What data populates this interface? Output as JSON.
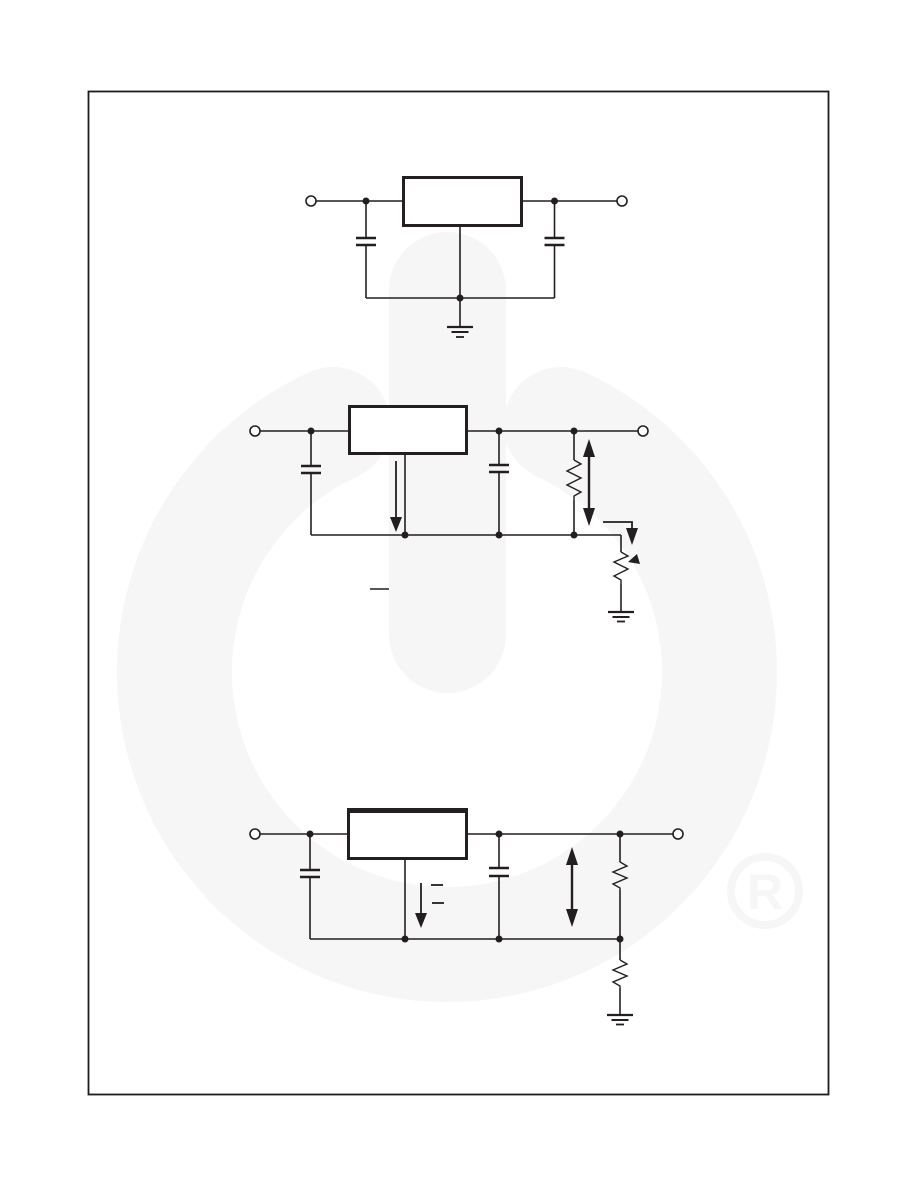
{
  "page": {
    "width": 918,
    "height": 1188,
    "background_color": "#ffffff",
    "frame_color": "#1c1c1c",
    "schematic_line_color": "#231f20",
    "watermark": {
      "name": "power-symbol-logo-watermark",
      "color": "#f6f6f7",
      "registered_mark": "R"
    }
  },
  "figures": [
    {
      "name": "fixed-output-regulator-circuit",
      "components": [
        "input-terminal",
        "input-capacitor",
        "regulator-box",
        "ground-pin",
        "output-capacitor",
        "output-terminal",
        "ground-symbol"
      ]
    },
    {
      "name": "adjustable-regulator-with-potentiometer-circuit",
      "components": [
        "input-terminal",
        "input-capacitor",
        "regulator-box",
        "quiescent-current-arrow",
        "output-capacitor",
        "feedback-resistor",
        "output-voltage-double-arrow",
        "adjust-current-bent-arrow",
        "potentiometer",
        "ground-symbol",
        "output-terminal",
        "formula-remnant-dash"
      ]
    },
    {
      "name": "adjustable-regulator-with-resistor-divider-circuit",
      "components": [
        "input-terminal",
        "input-capacitor",
        "regulator-box",
        "bias-current-arrow",
        "formula-remnant-dashes",
        "output-capacitor",
        "output-voltage-double-arrow",
        "upper-divider-resistor",
        "lower-divider-resistor",
        "ground-symbol",
        "output-terminal"
      ]
    }
  ]
}
